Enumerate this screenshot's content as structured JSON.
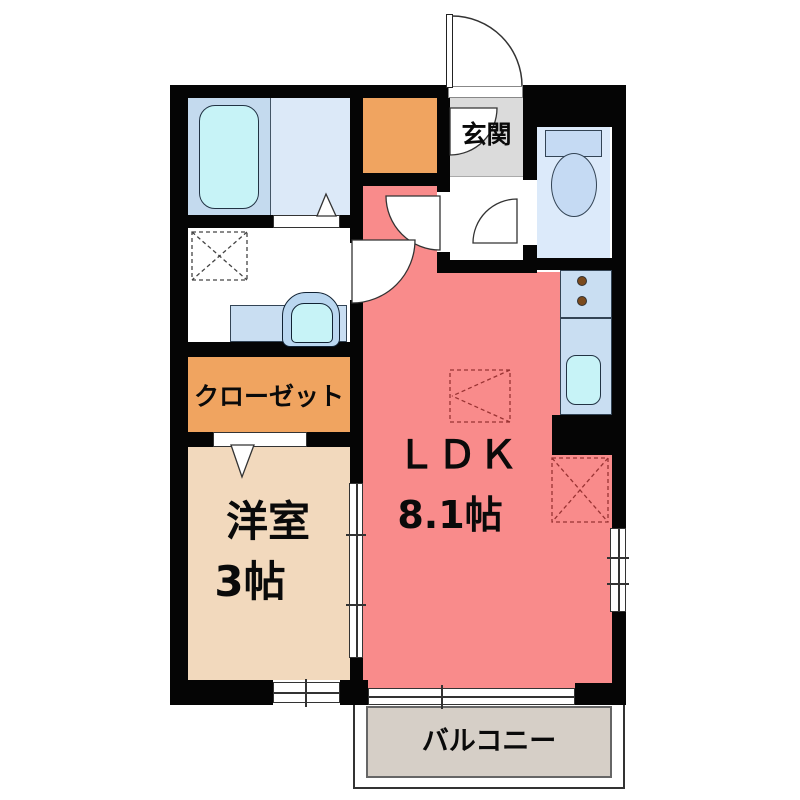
{
  "floor_plan": {
    "rooms": {
      "ldk": {
        "label": "ＬＤＫ",
        "size": "8.1帖"
      },
      "western_room": {
        "label": "洋室",
        "size": "3帖"
      },
      "closet": {
        "label": "クローゼット"
      },
      "entrance": {
        "label": "玄関"
      },
      "balcony": {
        "label": "バルコニー"
      }
    },
    "fixtures": [
      "bathtub",
      "toilet",
      "vanity-sink",
      "washing-machine-space",
      "kitchen-counter",
      "stove-burners",
      "kitchen-sink",
      "refrigerator-space",
      "storage",
      "door-swing",
      "sliding-door",
      "window"
    ],
    "colors": {
      "wall": "#050505",
      "ldk_pink": "#f98b8b",
      "room_orange": "#f0a460",
      "western_beige": "#f2d9bd",
      "balcony_gray": "#d6cfc7",
      "entrance_gray": "#dbdbdb",
      "bath_blue": "#c4daee",
      "bath_blue_lt": "#dce9f8",
      "toilet_blue": "#dceafa",
      "fixture_blue": "#c5daf3",
      "counter_blue": "#c9def2",
      "water_cyan": "#c7f3f7",
      "vanity_blue": "#bad7f0",
      "burner_brown": "#7b4a1d",
      "marker_red": "#993333",
      "floor_white": "#ffffff"
    }
  }
}
